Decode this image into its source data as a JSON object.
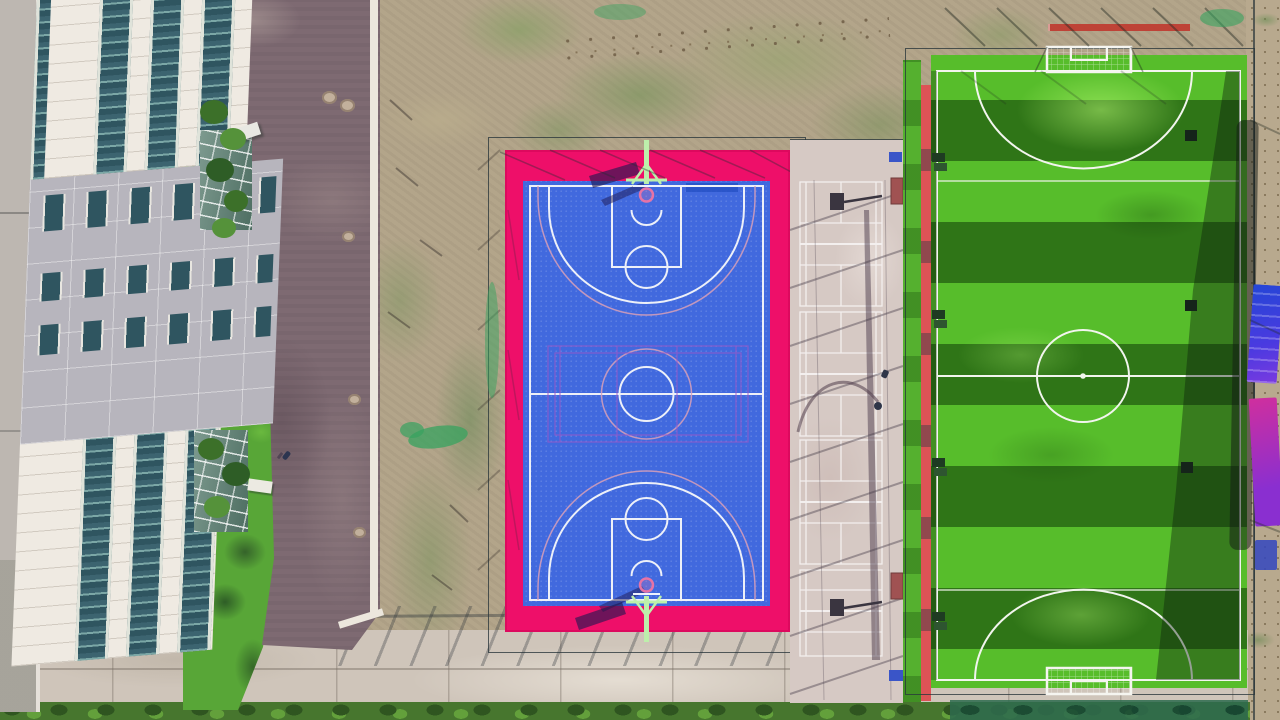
{
  "scene": {
    "type": "aerial-drone-photograph",
    "subject": "sports complex with basketball court, badminton courts and striped soccer field beside an office building",
    "view": "top-down",
    "lighting": "daytime sun casting shadows toward lower-left"
  },
  "palette": {
    "asphalt": "#7e6a72",
    "concrete": "#cfc5ba",
    "concrete_light": "#d8cfc4",
    "scrub": "#b3a58a",
    "lawn": "#58a637",
    "hedge": "#35632a",
    "facade": "#efeae2",
    "glass_dark": "#345964",
    "glass_light": "#7ba7a6",
    "gray_band": "#b7b5bd",
    "window_glass": "#2f5560",
    "court_pink": "#ee0f69",
    "court_blue": "#4169de",
    "court_line": "#edf0f8",
    "overlay_line": "#9a58c8",
    "bad_concrete": "#d6c9c4",
    "field_light": "#57bd2b",
    "field_dark": "#2f7517",
    "field_line": "#f2f5ee",
    "red_stripe": "#dd5356",
    "fence": "#29363b",
    "shadow": "#2a2438",
    "mint": "#bdefab",
    "rim_pink": "#e673a6",
    "banner_blue": "#2f48d2",
    "banner_purple": "#b136c9",
    "dirt": "#b8a98e",
    "curb": "#ece7dd",
    "bench_red": "#a05252",
    "bench_green": "#1e3b22",
    "net_green": "#37a35f"
  },
  "objects": {
    "building": {
      "glass_strips": 4,
      "window_rows": 3,
      "atriums": 2,
      "roof_slabs": 2
    },
    "road": {
      "manholes": 5,
      "pedestrians": 1,
      "curbs": "white"
    },
    "basketball_court": {
      "surface": "blue",
      "apron": "magenta-pink",
      "hoops": 2,
      "center_circles": 2,
      "three_point_arcs": 2,
      "overlay_court_lines": "purple"
    },
    "badminton_strip": {
      "courts": 4,
      "light_pole_shadow": 1,
      "benches": 2,
      "hose_shadow": 1
    },
    "soccer_field": {
      "mow_stripes": 11,
      "goals": 2,
      "penalty_arcs": 2,
      "center_circle": 1,
      "benches_left": 4,
      "markers_right": 3,
      "red_edge_stripe": true
    },
    "banners_right": 3,
    "fences": 3
  }
}
